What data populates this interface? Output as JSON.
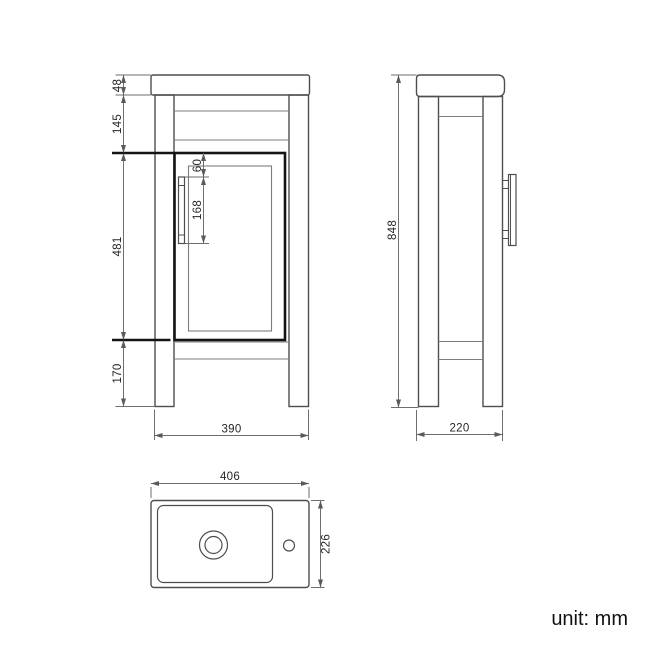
{
  "colors": {
    "outline": "#4e4e4e",
    "light_line": "#7d7d7d",
    "dim_line": "#6e6e6e",
    "accent_dark": "#141414",
    "text": "#262626"
  },
  "front_view": {
    "dims": {
      "countertop_thickness": "48",
      "upper_section_height": "145",
      "handle_top_offset": "60",
      "handle_length": "168",
      "door_section_height": "481",
      "leg_section_height": "170",
      "overall_width": "390"
    }
  },
  "side_view": {
    "dims": {
      "overall_height": "848",
      "overall_depth": "220"
    }
  },
  "top_view": {
    "dims": {
      "basin_width": "406",
      "basin_depth": "226"
    }
  },
  "footer": {
    "unit_label": "unit: mm"
  }
}
